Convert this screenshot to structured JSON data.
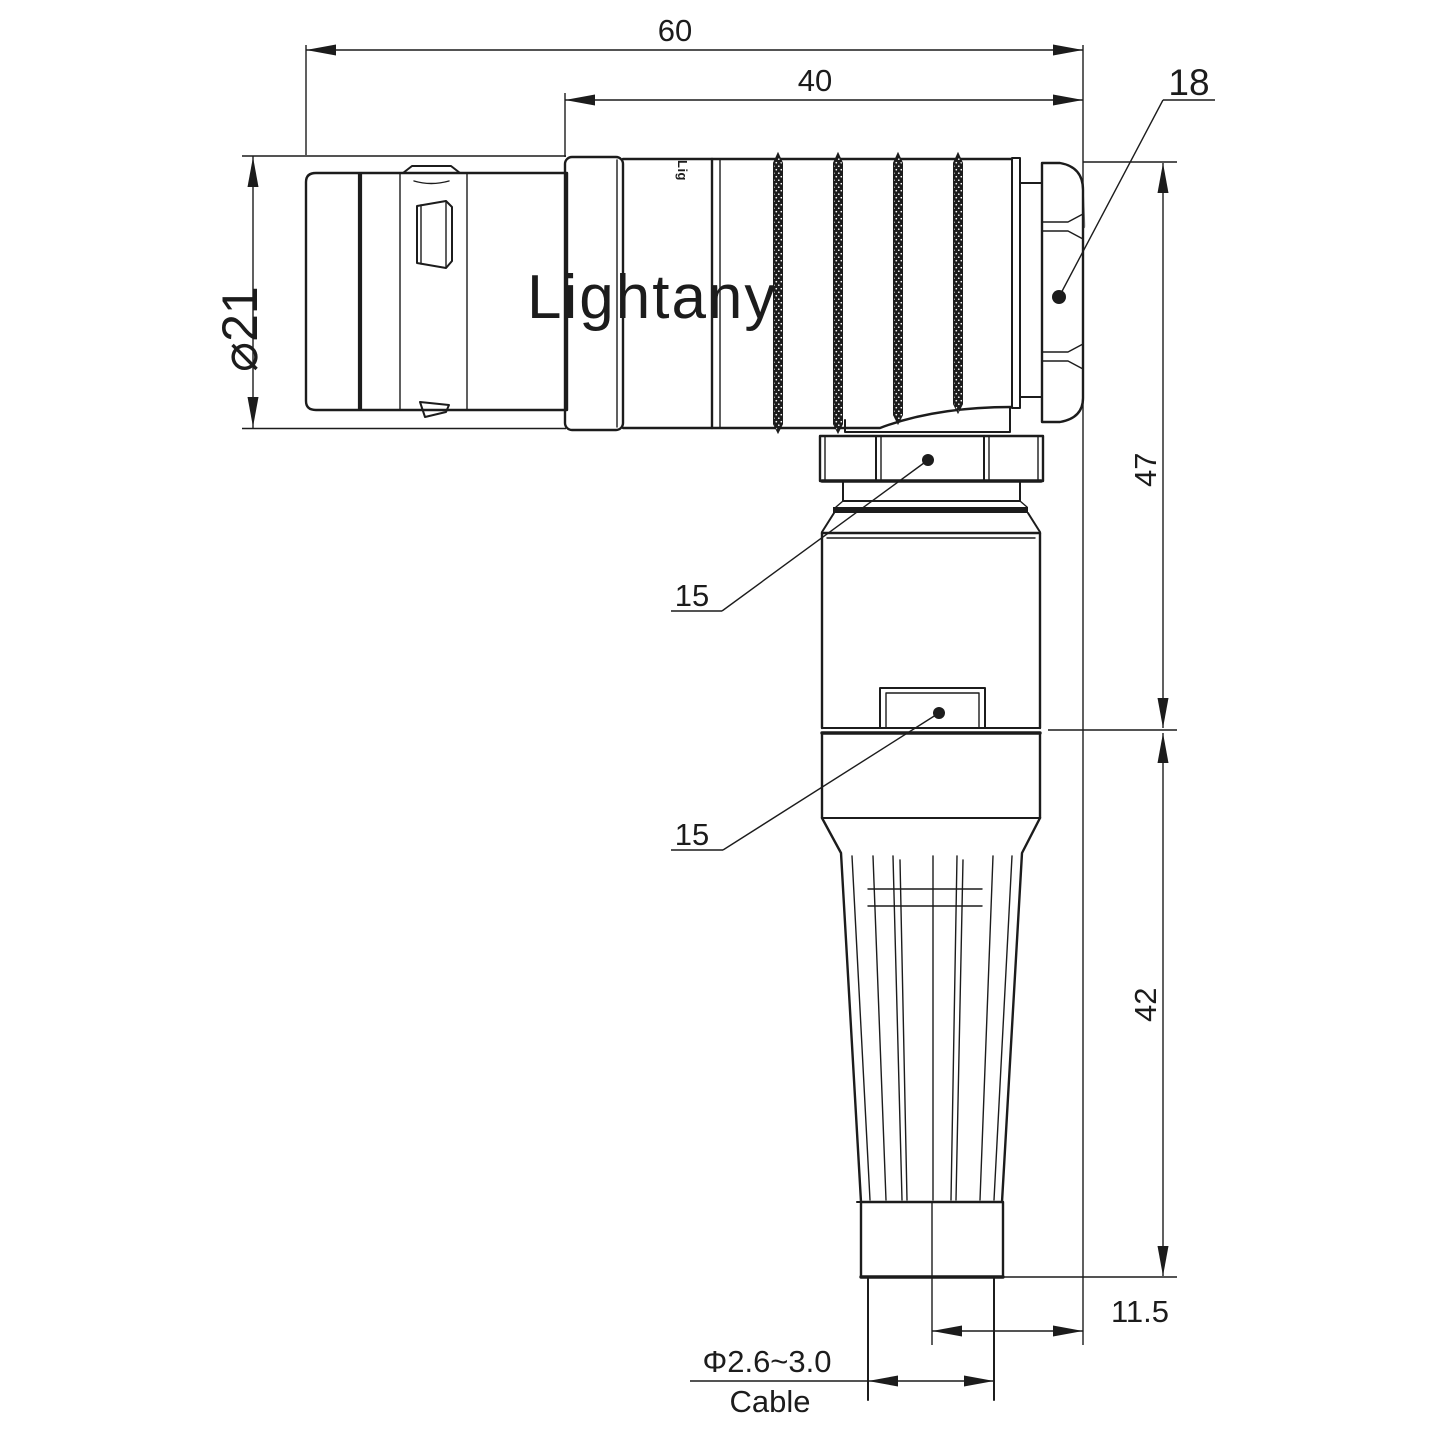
{
  "drawing": {
    "watermark_text": "Lightany",
    "shell_logo_text": "Lig",
    "labels": {
      "overall_length": "60",
      "body_length": "40",
      "backnut_size": "18",
      "plug_diameter": "⌀21",
      "upper_height": "47",
      "coupling_nut_flat": "15",
      "latch_flat": "15",
      "lower_height": "42",
      "cap_offset": "11.5",
      "cable_diameter_range": "Φ2.6~3.0",
      "cable_word": "Cable"
    },
    "colors": {
      "line": "#1c1c1c",
      "text": "#1c1c1c",
      "watermark": "#f7caca",
      "background": "#ffffff"
    }
  }
}
